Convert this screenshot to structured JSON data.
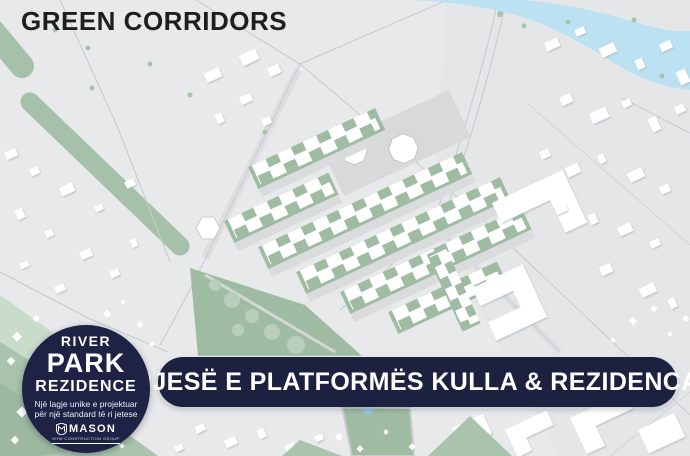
{
  "title": "GREEN CORRIDORS",
  "badge": {
    "line1": "RIVER",
    "line2": "PARK",
    "line3": "REZIDENCE",
    "tagline1": "Një lagje unike e projektuar",
    "tagline2": "për një standard të ri jetese",
    "brand": "MASON",
    "brand_sub": "MYM CONSTRUCTION GROUP"
  },
  "banner": {
    "label": "PJESË E PLATFORMËS KULLA & REZIDENCA"
  },
  "map": {
    "kind": "masterplan-site-map",
    "features": [
      "river",
      "green-corridors",
      "residential-development-rows",
      "towers-plaza",
      "existing-buildings",
      "park-with-trees",
      "roads",
      "confetti-decor"
    ],
    "colors": {
      "background": "#e7e9ea",
      "river_blue": "#bce1f2",
      "corridor_green": "#a6c1a9",
      "development_green": "#9fbca3",
      "tree_green": "#b9ceba",
      "pale_green": "#c9dbca",
      "building_white": "#ffffff",
      "road_line": "#c7cacd",
      "plaza_gray": "#d7d9db",
      "navy": "#1e2245"
    }
  }
}
